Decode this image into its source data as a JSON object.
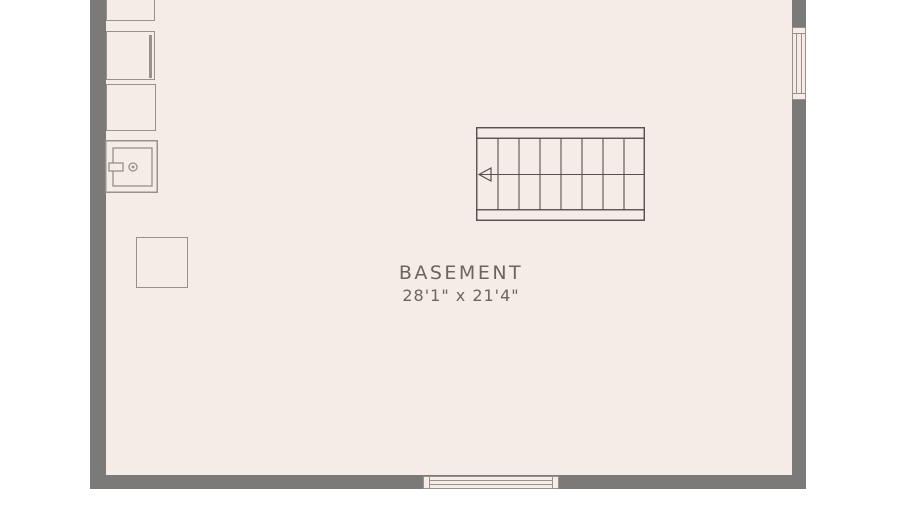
{
  "page": {
    "background": "#ffffff"
  },
  "floorplan": {
    "room": {
      "label": "BASEMENT",
      "dimensions": "28'1\" x 21'4\""
    },
    "colors": {
      "floor": "#f5ece7",
      "wall": "#7b7a78",
      "fixture_line": "#97918b",
      "stair_line": "#57524d",
      "text": "#6b655f"
    },
    "stairs": {
      "treads_per_row": 7,
      "rows": 2,
      "direction_arrow": "left"
    },
    "fixtures": [
      "storage-unit-top",
      "storage-unit-upper",
      "storage-unit-middle",
      "utility-appliance",
      "support-post"
    ],
    "windows": [
      "right-wall-window",
      "bottom-wall-window"
    ]
  }
}
